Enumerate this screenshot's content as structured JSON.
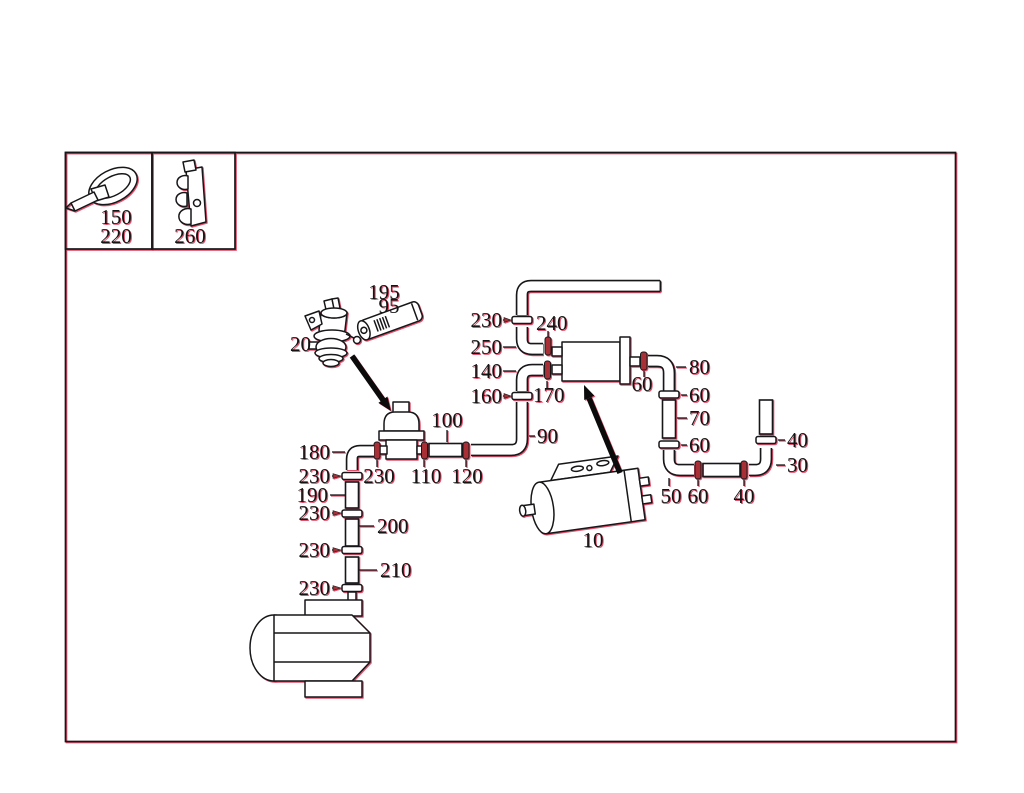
{
  "figure": {
    "type": "fuel-system-parts-diagram",
    "line_color": "#17171a",
    "accent_red": "#cc2a3c",
    "legend": {
      "tie_upper": "150",
      "tie_lower": "220",
      "clip": "260"
    },
    "callouts": {
      "valve": "20",
      "filter_a": "195",
      "filter_b": "95",
      "clamp_return_top": "230",
      "conn_240": "240",
      "elbow_250": "250",
      "elbow_140": "140",
      "clamp_160": "160",
      "conn_170": "170",
      "hose_100": "100",
      "elbow_90": "90",
      "elbow_180": "180",
      "conn_230": "230",
      "conn_110": "110",
      "conn_120": "120",
      "clamp_a": "230",
      "hose_190": "190",
      "clamp_b": "230",
      "hose_200": "200",
      "clamp_c": "230",
      "hose_210": "210",
      "clamp_d": "230",
      "canister": "10",
      "conn_60": "60",
      "elbow_80": "80",
      "clamp_60_up": "60",
      "hose_70": "70",
      "clamp_60_low": "60",
      "elbow_50": "50",
      "conn_60_b": "60",
      "conn_40": "40",
      "clamp_40": "40",
      "elbow_30": "30"
    }
  }
}
